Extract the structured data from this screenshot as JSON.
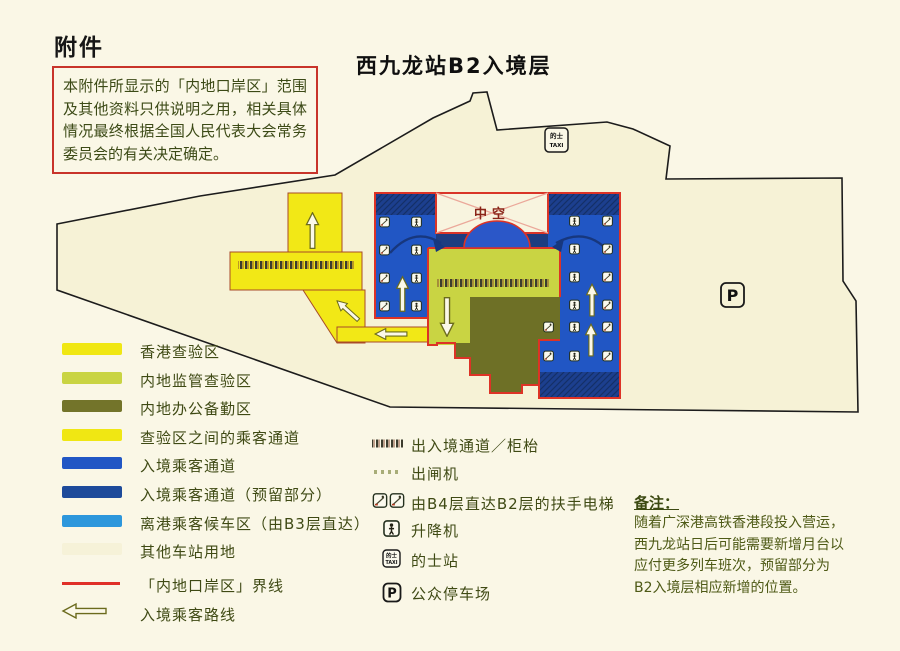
{
  "header": {
    "attachment_label": "附件",
    "map_title": "西九龙站B2入境层"
  },
  "disclaimer": {
    "text": "本附件所显示的「内地口岸区」范围及其他资料只供说明之用，相关具体情况最终根据全国人民代表大会常务委员会的有关决定确定。"
  },
  "map": {
    "void_label": "中空",
    "taxi_sign": {
      "cn": "的士",
      "en": "TAXI"
    },
    "parking_letter": "P"
  },
  "colors": {
    "boundary_red": "#dd3326",
    "hk_yellow": "#f2e816",
    "mainland_green": "#c9d443",
    "office_olive": "#6e7026",
    "passage_blue": "#2156c4",
    "reserved_navy": "#1c3f8e",
    "b3_lightblue": "#2d97dc",
    "station_cream": "#f6f2d6"
  },
  "legend_zones": {
    "items": [
      {
        "label": "香港查验区",
        "color": "#f0e713"
      },
      {
        "label": "内地监管查验区",
        "color": "#c9d443"
      },
      {
        "label": "内地办公备勤区",
        "color": "#73742a"
      },
      {
        "label": "查验区之间的乘客通道",
        "color": "#f0e713"
      },
      {
        "label": "入境乘客通道",
        "color": "#2156c4"
      },
      {
        "label": "入境乘客通道（预留部分）",
        "color": "#1d4a9a"
      },
      {
        "label": "离港乘客候车区（由B3层直达）",
        "color": "#2d97dc"
      },
      {
        "label": "其他车站用地",
        "color": "#f6f2d8"
      },
      {
        "label": "「内地口岸区」界线",
        "color": "#e03028"
      },
      {
        "label": "入境乘客路线",
        "color": "#6b6b1d"
      }
    ]
  },
  "legend_symbols": {
    "items": [
      {
        "icon": "counter-hatch-icon",
        "label": "出入境通道／柜枱"
      },
      {
        "icon": "exit-gate-icon",
        "label": "出闸机"
      },
      {
        "icon": "escalator-icon",
        "label": "由B4层直达B2层的扶手电梯"
      },
      {
        "icon": "lift-icon",
        "label": "升降机"
      },
      {
        "icon": "taxi-icon",
        "label": "的士站"
      },
      {
        "icon": "parking-icon",
        "label": "公众停车场"
      }
    ]
  },
  "note": {
    "heading": "备注：",
    "lines": [
      "随着广深港高铁香港段投入营运，",
      "西九龙站日后可能需要新增月台以",
      "应付更多列车班次，预留部分为",
      "B2入境层相应新增的位置。"
    ]
  }
}
